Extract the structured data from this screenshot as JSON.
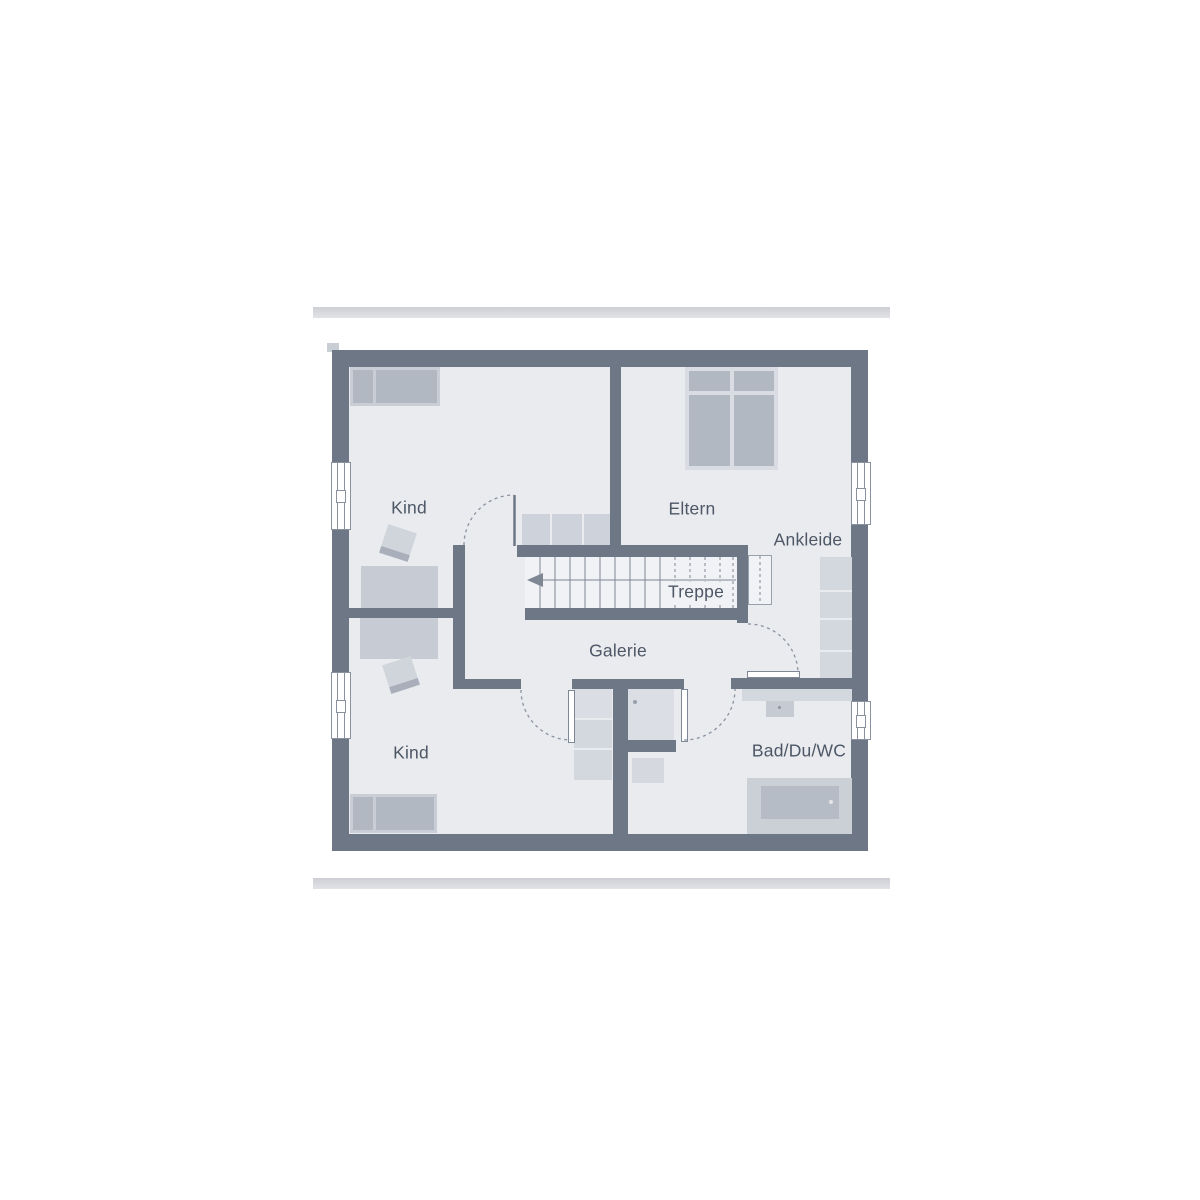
{
  "plan": {
    "type": "floor-plan",
    "floor_name": "Obergeschoss",
    "rooms": {
      "kind_top": {
        "label": "Kind"
      },
      "eltern": {
        "label": "Eltern"
      },
      "ankleide": {
        "label": "Ankleide"
      },
      "treppe": {
        "label": "Treppe"
      },
      "galerie": {
        "label": "Galerie"
      },
      "kind_bottom": {
        "label": "Kind"
      },
      "bad_du_wc": {
        "label": "Bad/Du/WC"
      }
    },
    "symbols": {
      "stair_arrow": "left-arrow",
      "stair_steps_solid": 9,
      "stair_steps_dashed": 5,
      "windows": 4,
      "doors": 4
    }
  },
  "colors": {
    "wall": "#6e7786",
    "floor": "#e9ebef",
    "stair_floor": "#f1f2f5",
    "furniture_light": "#c9ced6",
    "furniture_medium": "#b2b8c2",
    "bed_frame": "#d9dce2",
    "line": "#8a92a0",
    "label_text": "#4d5765",
    "frame_bar_dark": "#cdcfd5",
    "frame_bar_light": "#e2e3e7"
  }
}
